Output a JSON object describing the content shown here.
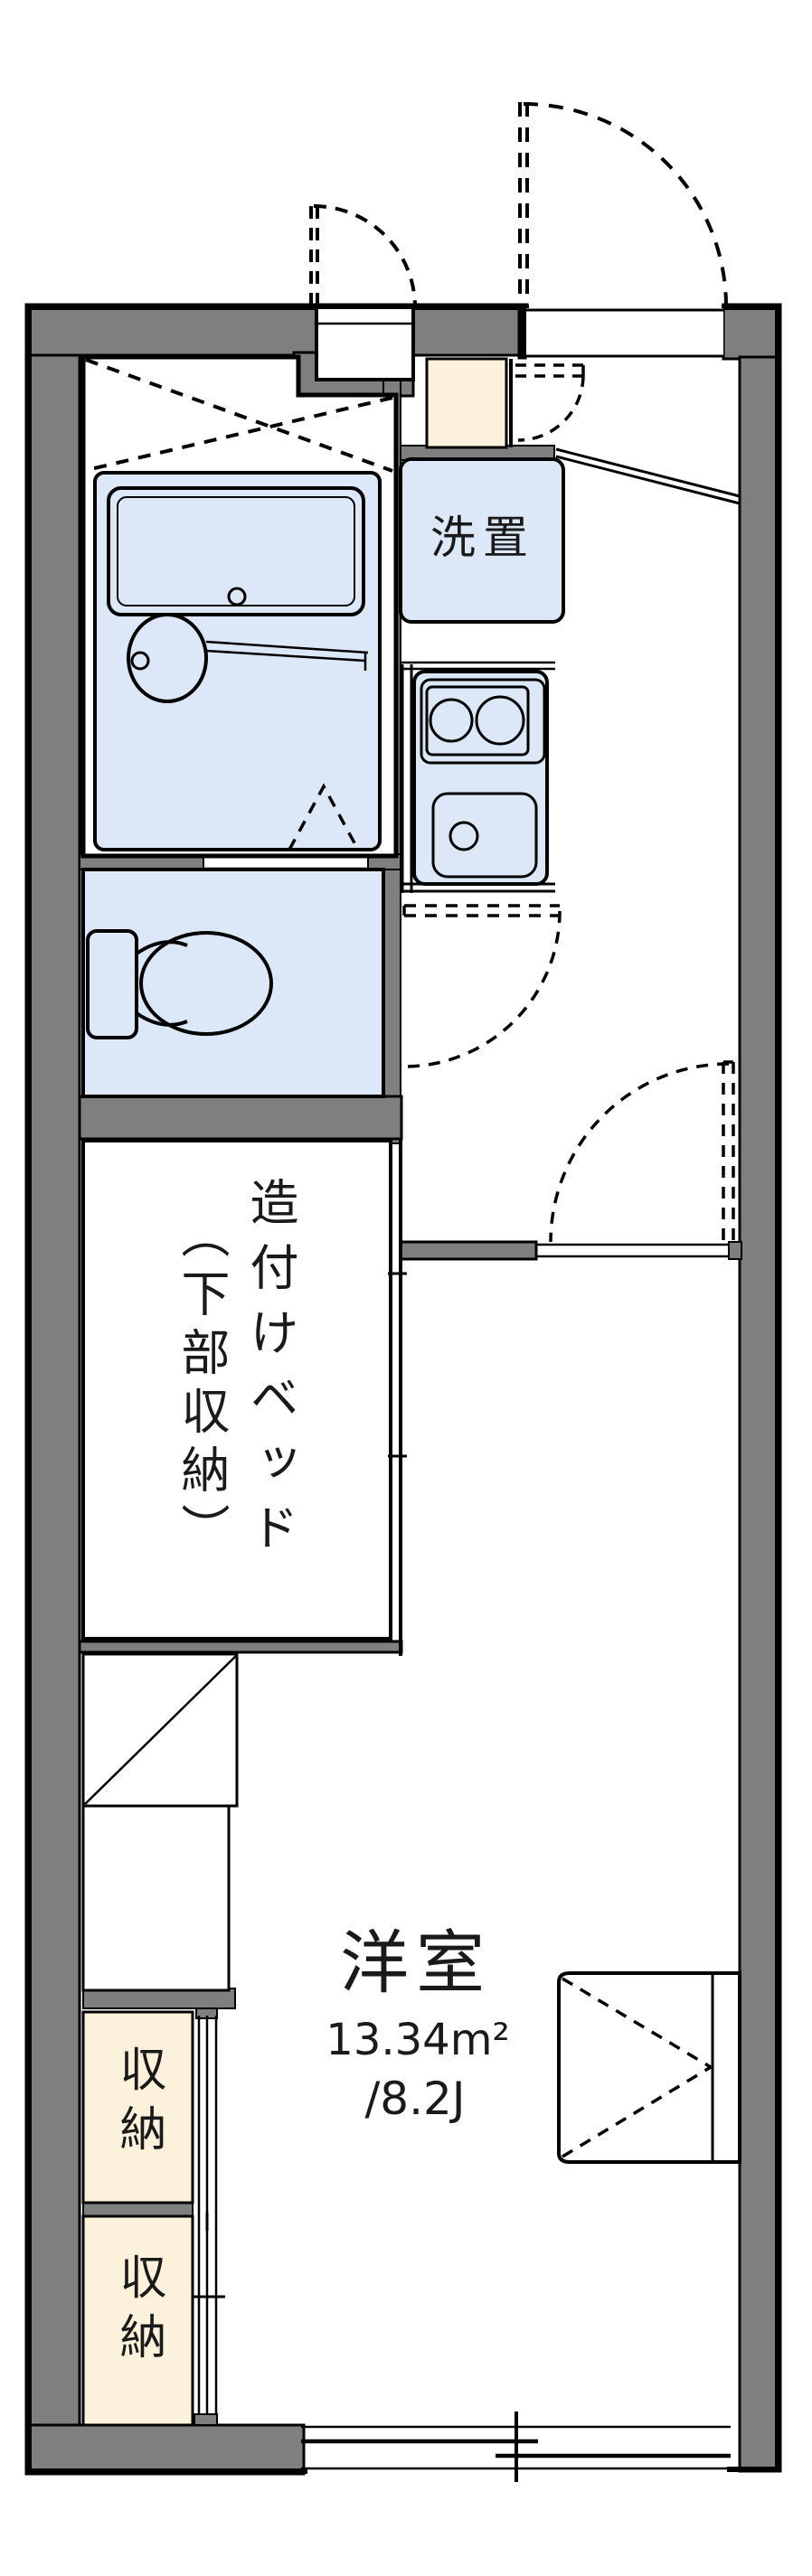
{
  "floorplan": {
    "kind": "apartment-floor-plan",
    "labels": {
      "washer_space": "洗置",
      "bed_line1": "造付けベッド",
      "bed_line2": "（下部収納）",
      "room_name": "洋室",
      "room_area_m2": "13.34m²",
      "room_area_jo": "/8.2J",
      "storage_upper": "収納",
      "storage_lower": "収納"
    },
    "colors": {
      "wall_gray": "#7f7f7f",
      "fixture_blue": "#dce8f7",
      "storage_cream": "#fcf1da",
      "outline": "#000000",
      "background": "#ffffff"
    }
  }
}
